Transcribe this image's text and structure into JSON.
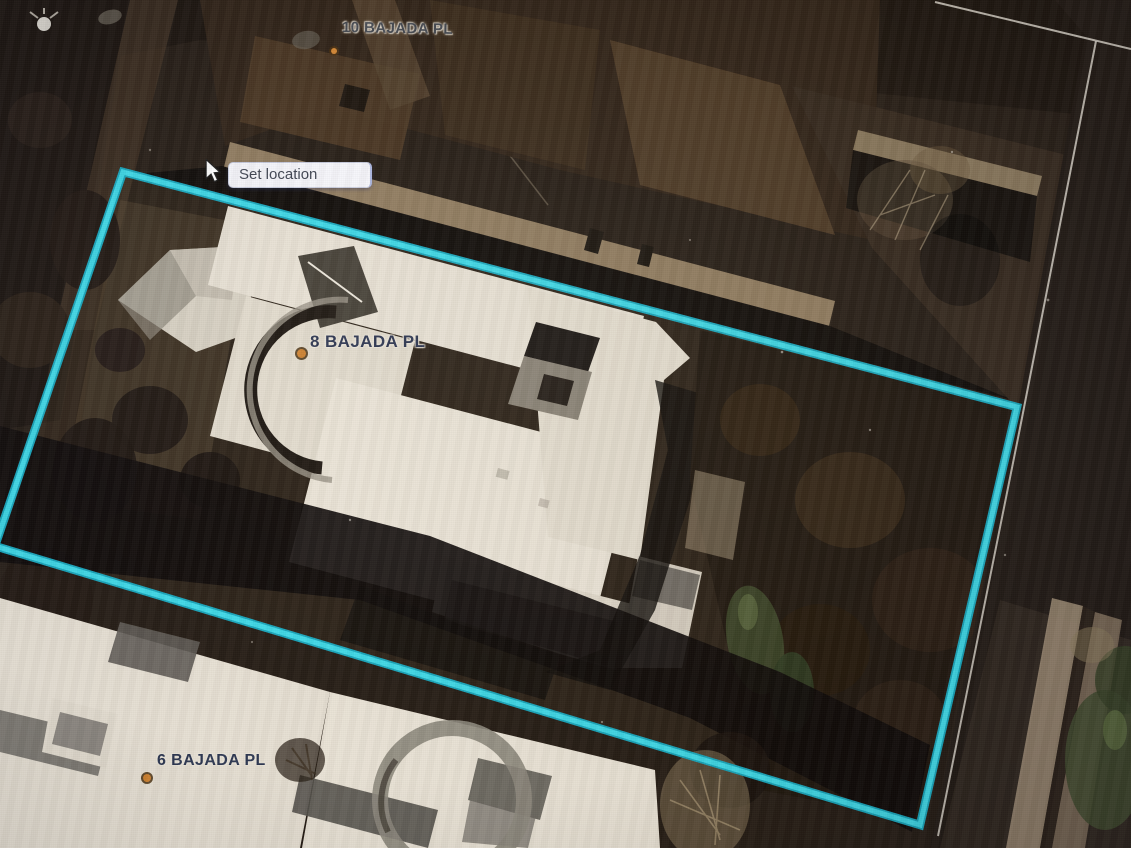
{
  "map": {
    "type": "aerial-parcel-view",
    "tooltip": {
      "label": "Set location"
    },
    "address_labels": [
      {
        "id": "10-bajada-pl",
        "text": "10 BAJADA PL"
      },
      {
        "id": "8-bajada-pl",
        "text": "8 BAJADA PL"
      },
      {
        "id": "6-bajada-pl",
        "text": "6 BAJADA PL"
      }
    ],
    "selected_parcel": {
      "address": "8 BAJADA PL",
      "outline_points": "123,172 1017,407 920,825 -5,546",
      "outline_color": "#35dcec",
      "outline_casing_color": "#0fa8c0"
    },
    "marker_color": "#cf8331",
    "label_text_color": "#2c3550",
    "tooltip_bg_color": "#f6f6fb"
  }
}
